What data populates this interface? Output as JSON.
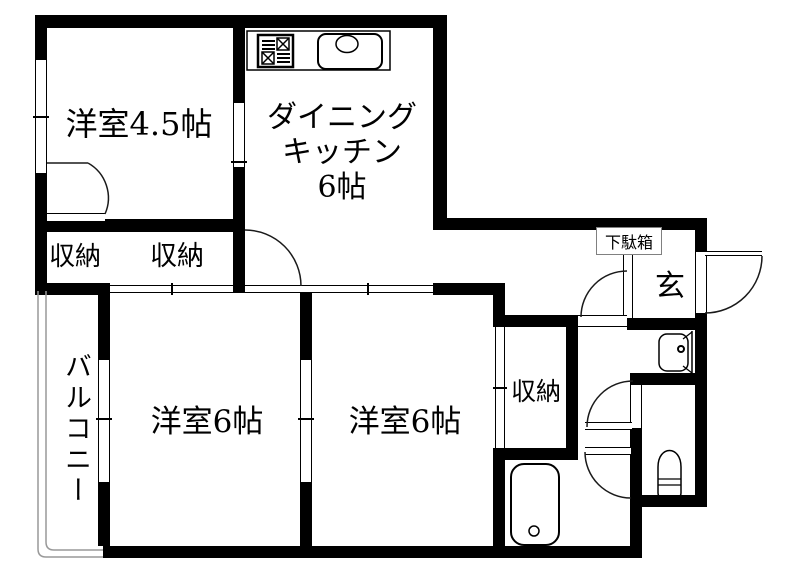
{
  "plan": {
    "type": "japanese-apartment-floorplan",
    "colors": {
      "background": "#ffffff",
      "wall": "#000000",
      "thin_line": "#1a1a1a",
      "balcony_line": "#999999",
      "shoe_box_border": "#808080"
    }
  },
  "labels": {
    "room_45": "洋室4.5帖",
    "dk_line1": "ダイニング",
    "dk_line2": "キッチン",
    "dk_line3": "6帖",
    "closet1": "収納",
    "closet2": "収納",
    "closet3": "収納",
    "room6_left": "洋室6帖",
    "room6_right": "洋室6帖",
    "balcony": "バルコニー",
    "entrance": "玄",
    "shoe_box": "下駄箱"
  },
  "fixtures": {
    "kitchen_stove": "gas-stove-icon",
    "kitchen_sink": "kitchen-sink-icon",
    "washbasin": "washbasin-icon",
    "toilet": "toilet-icon",
    "bathtub": "bathtub-icon"
  }
}
